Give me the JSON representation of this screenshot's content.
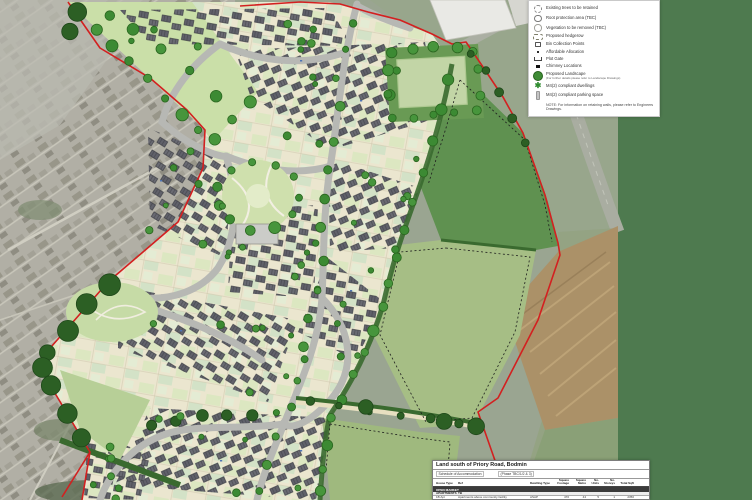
{
  "page": {
    "background_color": "#4e7a4f"
  },
  "legend": {
    "items": [
      {
        "label": "Existing trees to be retained"
      },
      {
        "label": "Root protection area (TBC)"
      },
      {
        "label": "Vegetation to be removed (TBC)"
      },
      {
        "label": "Proposed hedgerow"
      },
      {
        "label": "Bin Collection Points"
      },
      {
        "label": "Affordable Allocation"
      },
      {
        "label": "Plot Gate"
      },
      {
        "label": "Chimney Locations"
      },
      {
        "label": "Proposed Landscape",
        "sublabel": "(For further details please refer to Landscape Drawings)"
      },
      {
        "label": "M4(2) compliant dwellings"
      },
      {
        "label": "M4(2) compliant parking space"
      },
      {
        "label": "NOTE: For information on retaining walls, please refer to Engineers Drawings."
      }
    ]
  },
  "schedule": {
    "title": "Land south of Priory Road, Bodmin",
    "subtitle_left": "Schedule of Accommodation",
    "subtitle_right": "(Phase TBC/1/2 & 3)",
    "columns": [
      "House Type",
      "Ref",
      "Dwelling Type",
      "Square Footage",
      "Square Metre",
      "No. Units",
      "No. Storeys",
      "Total Sqft"
    ],
    "section_open_market": "OPEN MARKET",
    "subsection_apartments": "APARTMENTS",
    "subsection_ref": "TB",
    "rows": [
      {
        "house_type": "1B Apt",
        "ref": "Apartments above community facility",
        "dwelling_type": "ASAP",
        "sq_ft": "470",
        "sq_m": "44",
        "units": "5",
        "storeys": "1",
        "total": "2350"
      },
      {
        "house_type": "2B Apt",
        "ref": "Apartments above community facility",
        "dwelling_type": "ASAP",
        "sq_ft": "756",
        "sq_m": "70",
        "units": "5",
        "storeys": "1",
        "total": "3780"
      },
      {
        "house_type": "2B Apt",
        "ref": "Apartments above community facility",
        "dwelling_type": "ASAP",
        "sq_ft": "883",
        "sq_m": "77",
        "units": "5",
        "storeys": "1",
        "total": "4150"
      }
    ]
  }
}
